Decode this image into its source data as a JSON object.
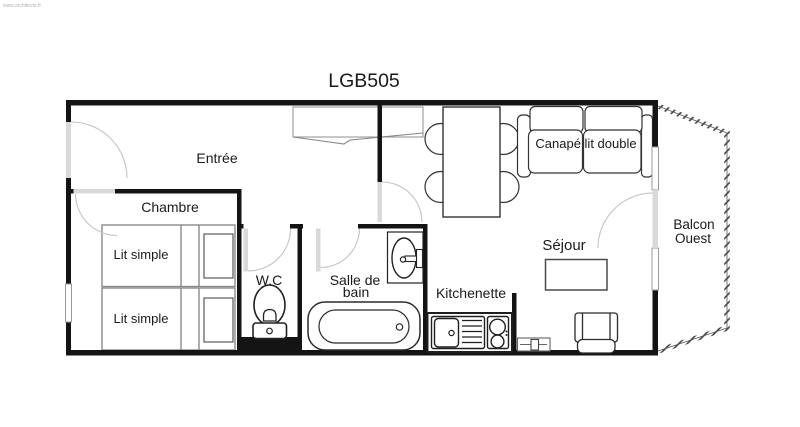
{
  "watermark": "www.architecte.fr",
  "title": "LGB505",
  "rooms": {
    "entree": "Entrée",
    "chambre": "Chambre",
    "wc": "W.C",
    "salle_de_bain": {
      "line1": "Salle de",
      "line2": "bain"
    },
    "kitchenette": "Kitchenette",
    "sejour": "Séjour",
    "balcon": {
      "line1": "Balcon",
      "line2": "Ouest"
    }
  },
  "furniture": {
    "lit_simple_1": "Lit simple",
    "lit_simple_2": "Lit simple",
    "canape_lit_double": "Canapé lit double"
  },
  "colors": {
    "wall": "#141414",
    "door_leaf": "#d9d9d9",
    "door_arc": "#c4c4c4",
    "outline_dark": "#2b2b2b",
    "outline_light": "#8a8a8a",
    "window_line": "#999999",
    "text": "#1a1a1a"
  }
}
